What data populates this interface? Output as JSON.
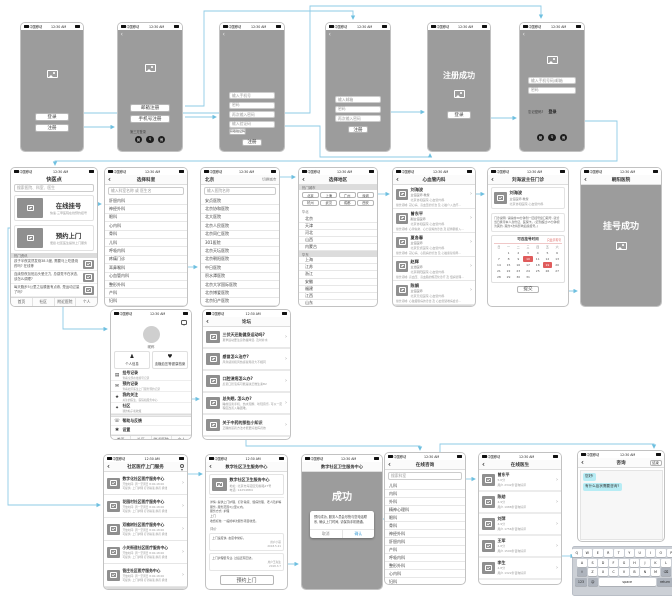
{
  "status": {
    "carrier": "中国移动",
    "time": "12:30 AM"
  },
  "tabs": [
    "首页",
    "社区",
    "附近医院",
    "个人"
  ],
  "colors": {
    "wire_blue": "#8ecbe6",
    "accent_red": "#e05c5c",
    "screen_grey": "#9c9c9c",
    "bubble_cyan": "#b7ecf4",
    "confirm_blue": "#3f9fd8"
  },
  "screens": {
    "welcome": {
      "login": "登录",
      "register": "注册"
    },
    "signup_options": {
      "email_register": "邮箱注册",
      "phone_register": "手机号注册",
      "third_party": "第三方登录"
    },
    "signup_phone": {
      "phone_placeholder": "输入手机号",
      "password_placeholder": "密码",
      "password2_placeholder": "再次输入密码",
      "code_placeholder": "输入验证码",
      "get_code": "获取验证码",
      "submit": "注册"
    },
    "signup_email": {
      "email_placeholder": "输入邮箱",
      "password_placeholder": "密码",
      "password2_placeholder": "再次输入密码",
      "submit": "注册"
    },
    "signup_success": {
      "message": "注册成功",
      "login": "登录"
    },
    "login": {
      "account_placeholder": "输入手机号码/邮箱",
      "password_placeholder": "密码",
      "forgot": "忘记密码?",
      "submit": "登录"
    },
    "home": {
      "title": "快医点",
      "search_placeholder": "搜索医院、科室、医生",
      "cards": [
        {
          "title": "在线挂号",
          "subtitle": "快速·三甲医院在线预约挂号"
        },
        {
          "title": "预约上门",
          "subtitle": "便捷·社区医生提供上门服务"
        }
      ],
      "section": "热门资讯",
      "news": [
        {
          "text": "孩子半夜突然发烧38.5度, 需要马上吃退烧药吗? 在线等"
        },
        {
          "text": "连续熬夜加班后头晕乏力, 总感觉不在状态, 该怎么调理?"
        },
        {
          "text": "每天跑步5公里之后膝盖有点疼, 是运动过量了吗?"
        }
      ]
    },
    "departments": {
      "title": "选择科室",
      "search_placeholder": "输入科室名称 或 医生名",
      "items": [
        "肝胆内科",
        "神经外科",
        "眼科",
        "心内科",
        "骨科",
        "儿科",
        "呼吸内科",
        "疼痛门诊",
        "耳鼻喉科",
        "心血管内科",
        "整形外科",
        "产科",
        "妇科"
      ]
    },
    "hospitals": {
      "city": "北京",
      "switch_city": "切换城市",
      "search_placeholder": "输入医院名称",
      "items": [
        "安贞医院",
        "北京协和医院",
        "北大医院",
        "北京人民医院",
        "北京同仁医院",
        "301医院",
        "北京天坛医院",
        "北京朝阳医院",
        "中日医院",
        "积水潭医院",
        "北京大学国际医院",
        "北京博爱医院",
        "北京妇产医院"
      ]
    },
    "regions": {
      "title": "选择地区",
      "hot_label": "热门城市",
      "hot": [
        "北京",
        "上海",
        "广州",
        "深圳",
        "杭州",
        "武汉",
        "成都",
        "西安"
      ],
      "groups": [
        {
          "name": "华北",
          "items": [
            "北京",
            "天津",
            "河北",
            "山西",
            "内蒙古"
          ]
        },
        {
          "name": "华东",
          "items": [
            "上海",
            "江苏",
            "浙江",
            "安徽",
            "福建",
            "江西",
            "山东"
          ]
        }
      ]
    },
    "doctors": {
      "title": "心血管内科",
      "items": [
        {
          "name": "刘海波",
          "grade": "主任医师 教授",
          "hospital": "北京协和医院 心血管内科",
          "desc": "擅长领域: 冠心病、高血压的诊治 及 心脏介入治疗…"
        },
        {
          "name": "曾东平",
          "grade": "副主任医师",
          "hospital": "北京协和医院 心血管内科",
          "desc": "擅长领域: 心律失常、心力衰竭的诊治 及 起搏器植入…"
        },
        {
          "name": "夏各春",
          "grade": "主任医师",
          "hospital": "北京安贞医院 心血管内科",
          "desc": "擅长领域: 冠心病、心肌病的诊治 及 心脏康复指导…"
        },
        {
          "name": "赵辉",
          "grade": "主治医师",
          "hospital": "北京朝阳医院 心血管内科",
          "desc": "擅长领域: 高血压、高血脂的规范化诊疗 及 慢病管理…"
        },
        {
          "name": "陈娟",
          "grade": "主任医师",
          "hospital": "北京天坛医院 心血管内科",
          "desc": "擅长领域: 心脏瓣膜病的诊治 及 心血管疑难病会诊…"
        }
      ]
    },
    "booking": {
      "title": "刘海波主任门诊",
      "doctor": {
        "name": "刘海波",
        "grade": "主任医师 教授",
        "hospital": "北京协和医院 心血管内科"
      },
      "note": "门诊说明: 请提前30分钟到一层挂号窗口取号, 就诊当日携带本人身份证、医保卡。(迟到超过15分钟视为爽约, 爽约3次将影响后续挂号。)",
      "cal_title": "可选挂号时间",
      "cal_link": "只显示有号",
      "weekdays": [
        "日",
        "一",
        "二",
        "三",
        "四",
        "五",
        "六"
      ],
      "days": [
        {
          "d": ""
        },
        {
          "d": "1"
        },
        {
          "d": "2"
        },
        {
          "d": "3"
        },
        {
          "d": "4"
        },
        {
          "d": "5"
        },
        {
          "d": "6"
        },
        {
          "d": "7"
        },
        {
          "d": "8"
        },
        {
          "d": "9"
        },
        {
          "d": "10",
          "cls": "sel"
        },
        {
          "d": "11"
        },
        {
          "d": "12"
        },
        {
          "d": "13"
        },
        {
          "d": "14"
        },
        {
          "d": "15"
        },
        {
          "d": "16"
        },
        {
          "d": "17"
        },
        {
          "d": "18"
        },
        {
          "d": "19",
          "cls": "sel"
        },
        {
          "d": "20"
        },
        {
          "d": "21"
        },
        {
          "d": "22"
        },
        {
          "d": "23"
        },
        {
          "d": "24"
        },
        {
          "d": "25"
        },
        {
          "d": "26"
        },
        {
          "d": "27"
        },
        {
          "d": "28"
        },
        {
          "d": "29"
        },
        {
          "d": "30"
        },
        {
          "d": "31"
        }
      ],
      "submit": "提交"
    },
    "booking_success": {
      "title": "朝阳医院",
      "message": "挂号成功"
    },
    "profile": {
      "nickname": "昵称",
      "cards": [
        {
          "icon": "♟",
          "label": "个人信息"
        },
        {
          "icon": "♥",
          "label": "血糖血压等健康档案"
        }
      ],
      "menu": [
        {
          "icon": "▤",
          "title": "挂号记录",
          "sub": "查看全部在线挂号记录"
        },
        {
          "icon": "✉",
          "title": "预约记录",
          "sub": "查看社区医生上门服务预约记录"
        },
        {
          "icon": "★",
          "title": "我的关注",
          "sub": "关注的医生、医院和服务中心"
        },
        {
          "icon": "✦",
          "title": "社区",
          "sub": "我的帖子和收藏"
        }
      ],
      "menu2": [
        {
          "icon": "☏",
          "title": "帮助与反馈"
        },
        {
          "icon": "✱",
          "title": "设置"
        }
      ]
    },
    "forum": {
      "title": "论坛",
      "posts": [
        {
          "title": "三伏天还能健身运动吗?",
          "sub": "夏季运动要注意防暑降温, 及时补水"
        },
        {
          "title": "感冒怎么治疗?",
          "sub": "风寒感冒和风热感冒用药大不相同"
        },
        {
          "title": "口腔溃疡怎么办?",
          "sub": "反复口腔溃疡可能是缺乏维生素B2"
        },
        {
          "title": "总失眠, 怎么办?",
          "sub": "睡前远离手机、热水泡脚、听轻音乐, 可以一定程度改善入睡困难。"
        },
        {
          "title": "关于中药的那些小知识",
          "sub": "正确的煎药方法才能更好发挥药效"
        }
      ]
    },
    "community_list": {
      "title": "社区医疗上门服务",
      "items": [
        {
          "name": "数字化社区医疗服务中心",
          "line1": "开放时间: 周一至周日 8:00-18:00",
          "line2": "可提供: 上门护理 打针输液 换药 拆线"
        },
        {
          "name": "花园村社区医疗服务中心",
          "line1": "开放时间: 周一至周日 8:00-18:00",
          "line2": "可提供: 上门护理 打针输液 换药 拆线"
        },
        {
          "name": "双榆树社区医疗服务中心",
          "line1": "开放时间: 周一至周日 8:00-18:00",
          "line2": "可提供: 上门护理 打针输液 换药 拆线"
        },
        {
          "name": "小关街道社区医疗服务中心",
          "line1": "开放时间: 周一至周日 8:00-18:00",
          "line2": "可提供: 上门护理 打针输液 换药 拆线"
        },
        {
          "name": "管庄社区医疗服务中心",
          "line1": "开放时间: 周一至周日 8:00-18:00",
          "line2": "可提供: 上门护理 打针输液 换药 拆线"
        }
      ]
    },
    "community_detail": {
      "title": "数字社区卫生服务中心",
      "name": "数字社区卫生服务中心",
      "address": "地址: 北京市海淀区知春路27号",
      "phone": "电话: 14254884",
      "detail_lines": [
        "详情: 提供上门护理、打针输液、慢病管理、老人陪护等服务, 服务范围3公里以内。",
        "服务方式: 护理",
        "上门",
        "收费标准: 一般按单次服务项目收费。"
      ],
      "reviews_label": "评价",
      "reviews": [
        {
          "text": "上门速度快, 态度非常好。",
          "user": "用户小丽",
          "date": "2018.5.21"
        },
        {
          "text": "上门护理很专业, 过后还有回访。",
          "user": "用户王先生",
          "date": "2018.3.7"
        }
      ],
      "submit": "预约上门"
    },
    "community_success": {
      "title": "数字社区卫生服务中心",
      "message": "成功",
      "dialog": "预约成功, 服务人员会尽快与您电话联系, 确认上门时间, 请保持手机畅通。",
      "cancel": "取消",
      "confirm": "确认"
    },
    "consult_departments": {
      "title": "在线咨询",
      "search_placeholder": "搜索科室",
      "items": [
        "儿科",
        "内科",
        "外科",
        "精神心理科",
        "眼科",
        "骨科",
        "神经外科",
        "肝胆内科",
        "产科",
        "呼吸内科",
        "整形外科",
        "心内科",
        "妇科"
      ]
    },
    "consult_doctors": {
      "title": "在线医生",
      "items": [
        {
          "name": "曾东平",
          "score": "5.0分",
          "sub": "用户·2342条咨询好评"
        },
        {
          "name": "陈勋",
          "score": "4.9分",
          "sub": "用户·1988条咨询好评"
        },
        {
          "name": "刘萍",
          "score": "4.9分",
          "sub": "用户·1756条咨询好评"
        },
        {
          "name": "王军",
          "score": "4.8分",
          "sub": "用户·1590条咨询好评"
        },
        {
          "name": "李生",
          "score": "4.8分",
          "sub": "用户·1322条咨询好评"
        }
      ]
    },
    "chat": {
      "title": "咨询",
      "end": "结束",
      "bubbles": [
        "您好!",
        "有什么症状需要咨询?"
      ],
      "keyboard": {
        "row1": [
          "Q",
          "W",
          "E",
          "R",
          "T",
          "Y",
          "U",
          "I",
          "O",
          "P"
        ],
        "row2": [
          "A",
          "S",
          "D",
          "F",
          "G",
          "H",
          "J",
          "K",
          "L"
        ],
        "row3": [
          "Z",
          "X",
          "C",
          "V",
          "B",
          "N",
          "M"
        ],
        "shift": "⇧",
        "backspace": "⌫",
        "num": "123",
        "emoji": "☺",
        "space": "space",
        "return": "return"
      }
    }
  }
}
